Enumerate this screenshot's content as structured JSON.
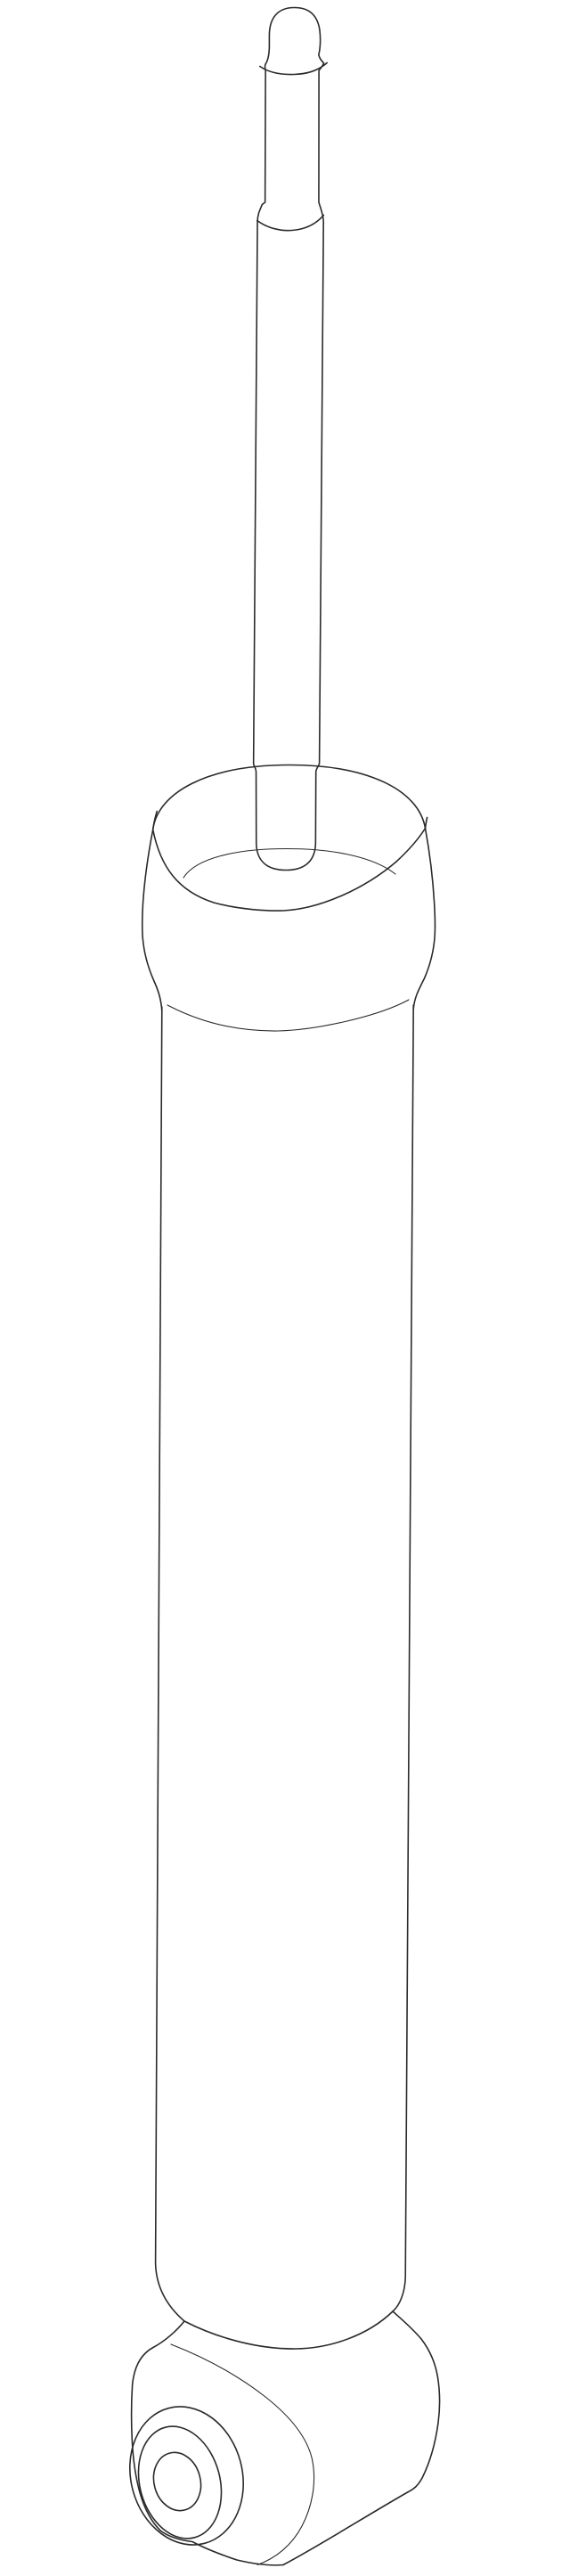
{
  "page": {
    "background": "#ffffff",
    "kind": "line-art parts illustration",
    "subject": "rear shock absorber, isometric outline drawing, no text or labels visible"
  },
  "drawing": {
    "stroke_primary": "#2a2a2a",
    "stroke_secondary": "#444444",
    "fill": "#ffffff",
    "components": [
      {
        "name": "rod-tip-cap",
        "desc": "domed cap on top of piston rod"
      },
      {
        "name": "piston-rod-upper",
        "desc": "thin upper piston rod segment"
      },
      {
        "name": "rod-step",
        "desc": "step where rod widens"
      },
      {
        "name": "piston-rod-lower",
        "desc": "wider rod entering spring seat cup"
      },
      {
        "name": "spring-seat-cup",
        "desc": "conical upper cup / spring seat collar"
      },
      {
        "name": "cup-floor",
        "desc": "inner floor ellipse of cup"
      },
      {
        "name": "reservoir-tube",
        "desc": "long cylindrical shock body"
      },
      {
        "name": "lower-eye-mount",
        "desc": "bottom eye mount barrel"
      },
      {
        "name": "bushing-outer-ring",
        "desc": "outer rubber bushing ring on eye face"
      },
      {
        "name": "bushing-inner-ring",
        "desc": "inner bushing sleeve ring"
      },
      {
        "name": "bushing-bore",
        "desc": "center bore hole of bushing"
      }
    ]
  }
}
